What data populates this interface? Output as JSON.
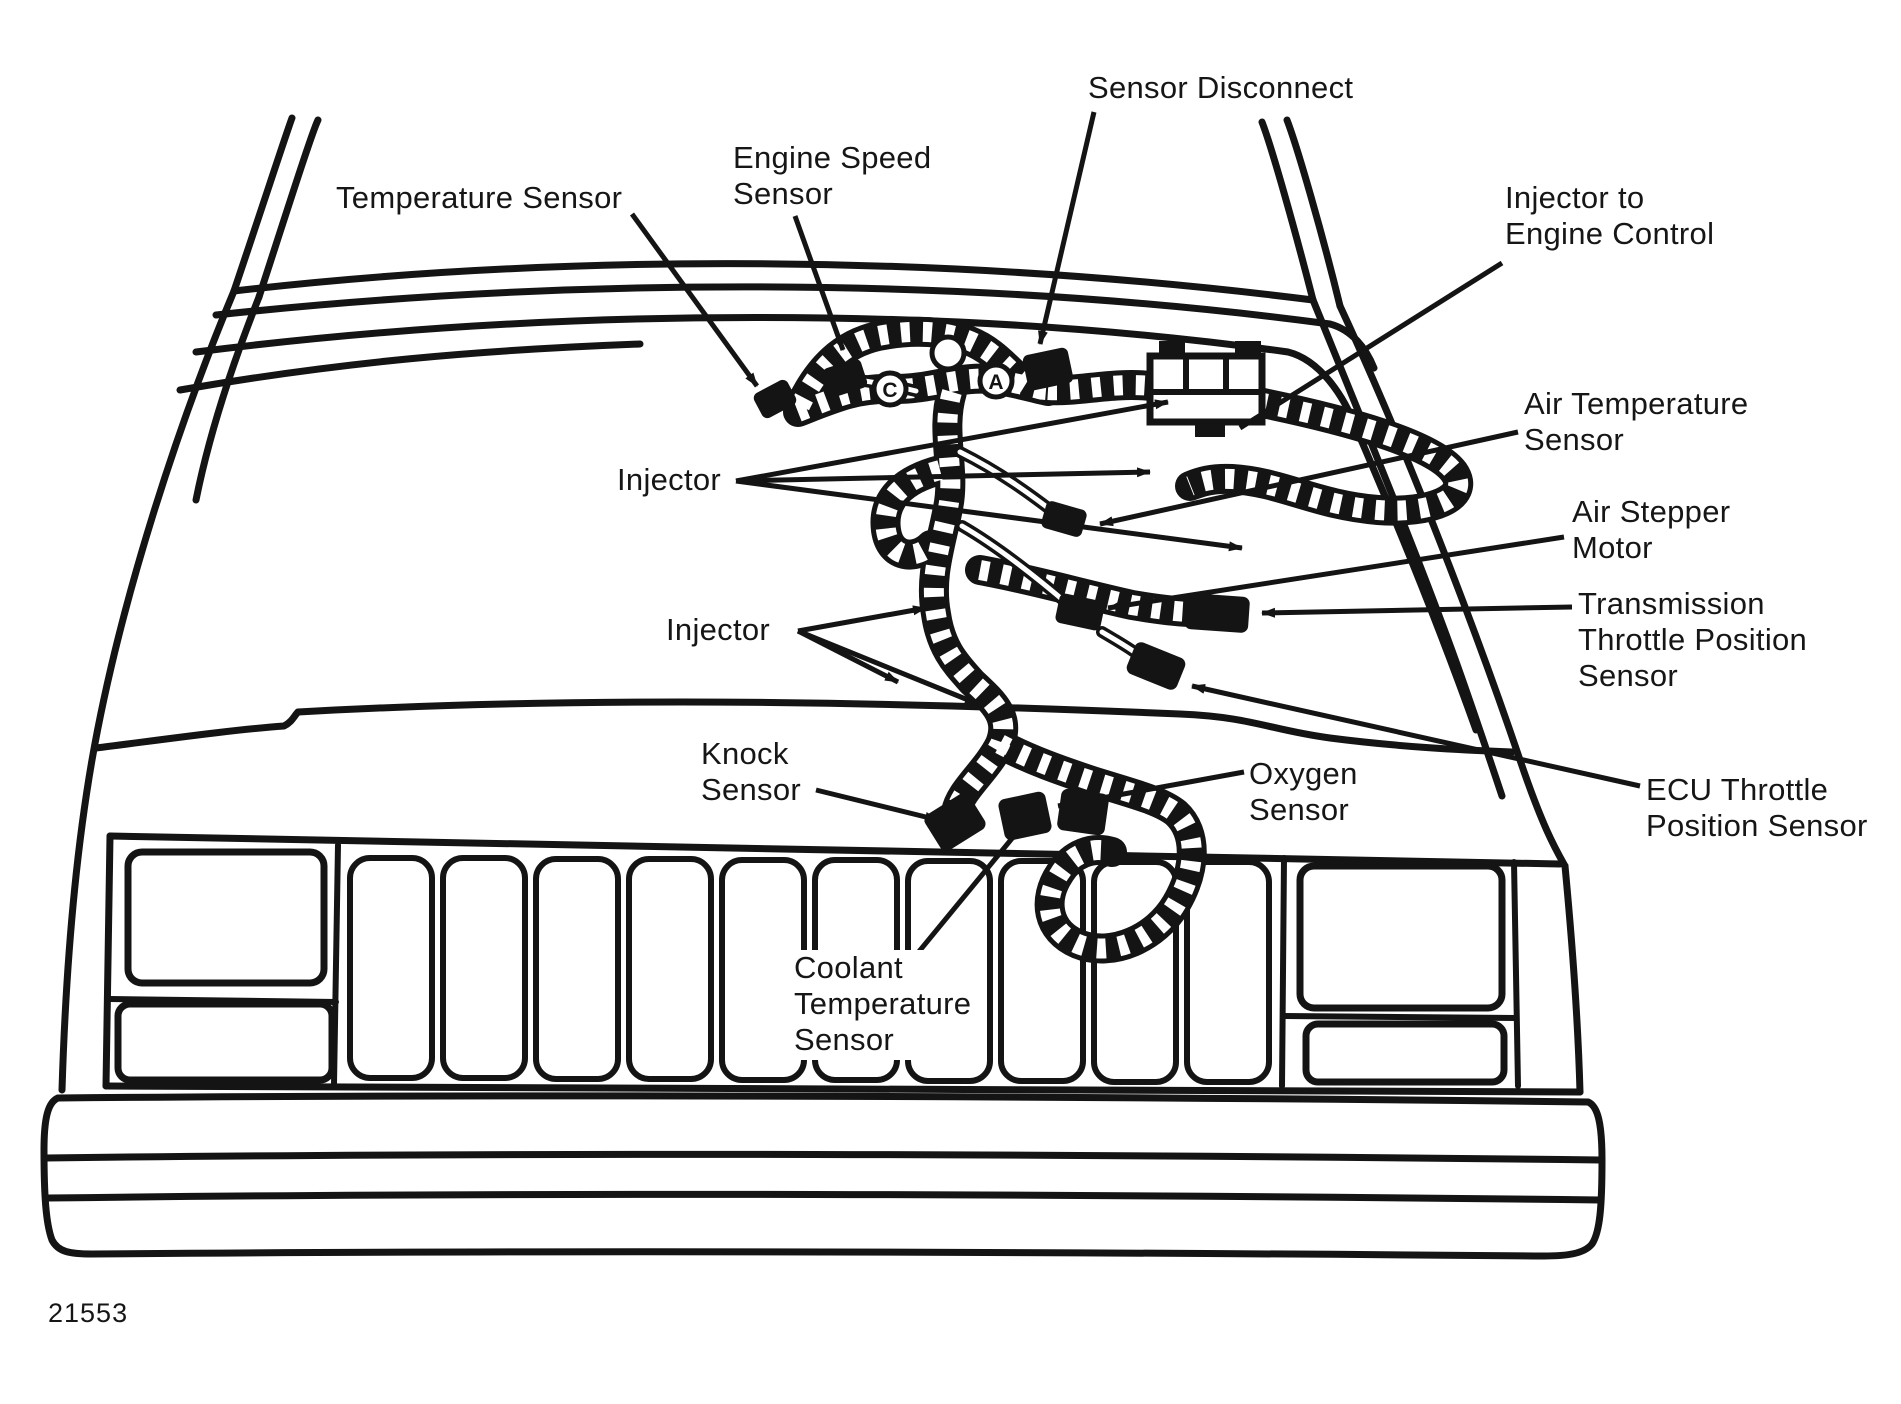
{
  "figure": {
    "number": "21553"
  },
  "colors": {
    "ink": "#141414",
    "paper": "#ffffff"
  },
  "labels": {
    "temperature_sensor": {
      "lines": [
        "Temperature Sensor"
      ]
    },
    "engine_speed_sensor": {
      "lines": [
        "Engine Speed",
        "Sensor"
      ]
    },
    "sensor_disconnect": {
      "lines": [
        "Sensor Disconnect"
      ]
    },
    "injector_to_engine_control": {
      "lines": [
        "Injector to",
        "Engine Control"
      ]
    },
    "air_temperature_sensor": {
      "lines": [
        "Air Temperature",
        "Sensor"
      ]
    },
    "air_stepper_motor": {
      "lines": [
        "Air Stepper",
        "Motor"
      ]
    },
    "transmission_throttle_position_sensor": {
      "lines": [
        "Transmission",
        "Throttle Position",
        "Sensor"
      ]
    },
    "ecu_throttle_position_sensor": {
      "lines": [
        "ECU Throttle",
        "Position Sensor"
      ]
    },
    "injector_upper": {
      "lines": [
        "Injector"
      ]
    },
    "injector_lower": {
      "lines": [
        "Injector"
      ]
    },
    "knock_sensor": {
      "lines": [
        "Knock",
        "Sensor"
      ]
    },
    "oxygen_sensor": {
      "lines": [
        "Oxygen",
        "Sensor"
      ]
    },
    "coolant_temperature_sensor": {
      "lines": [
        "Coolant",
        "Temperature",
        "Sensor"
      ]
    }
  },
  "harness_markers": {
    "first": "C",
    "second": "",
    "third": "A"
  }
}
